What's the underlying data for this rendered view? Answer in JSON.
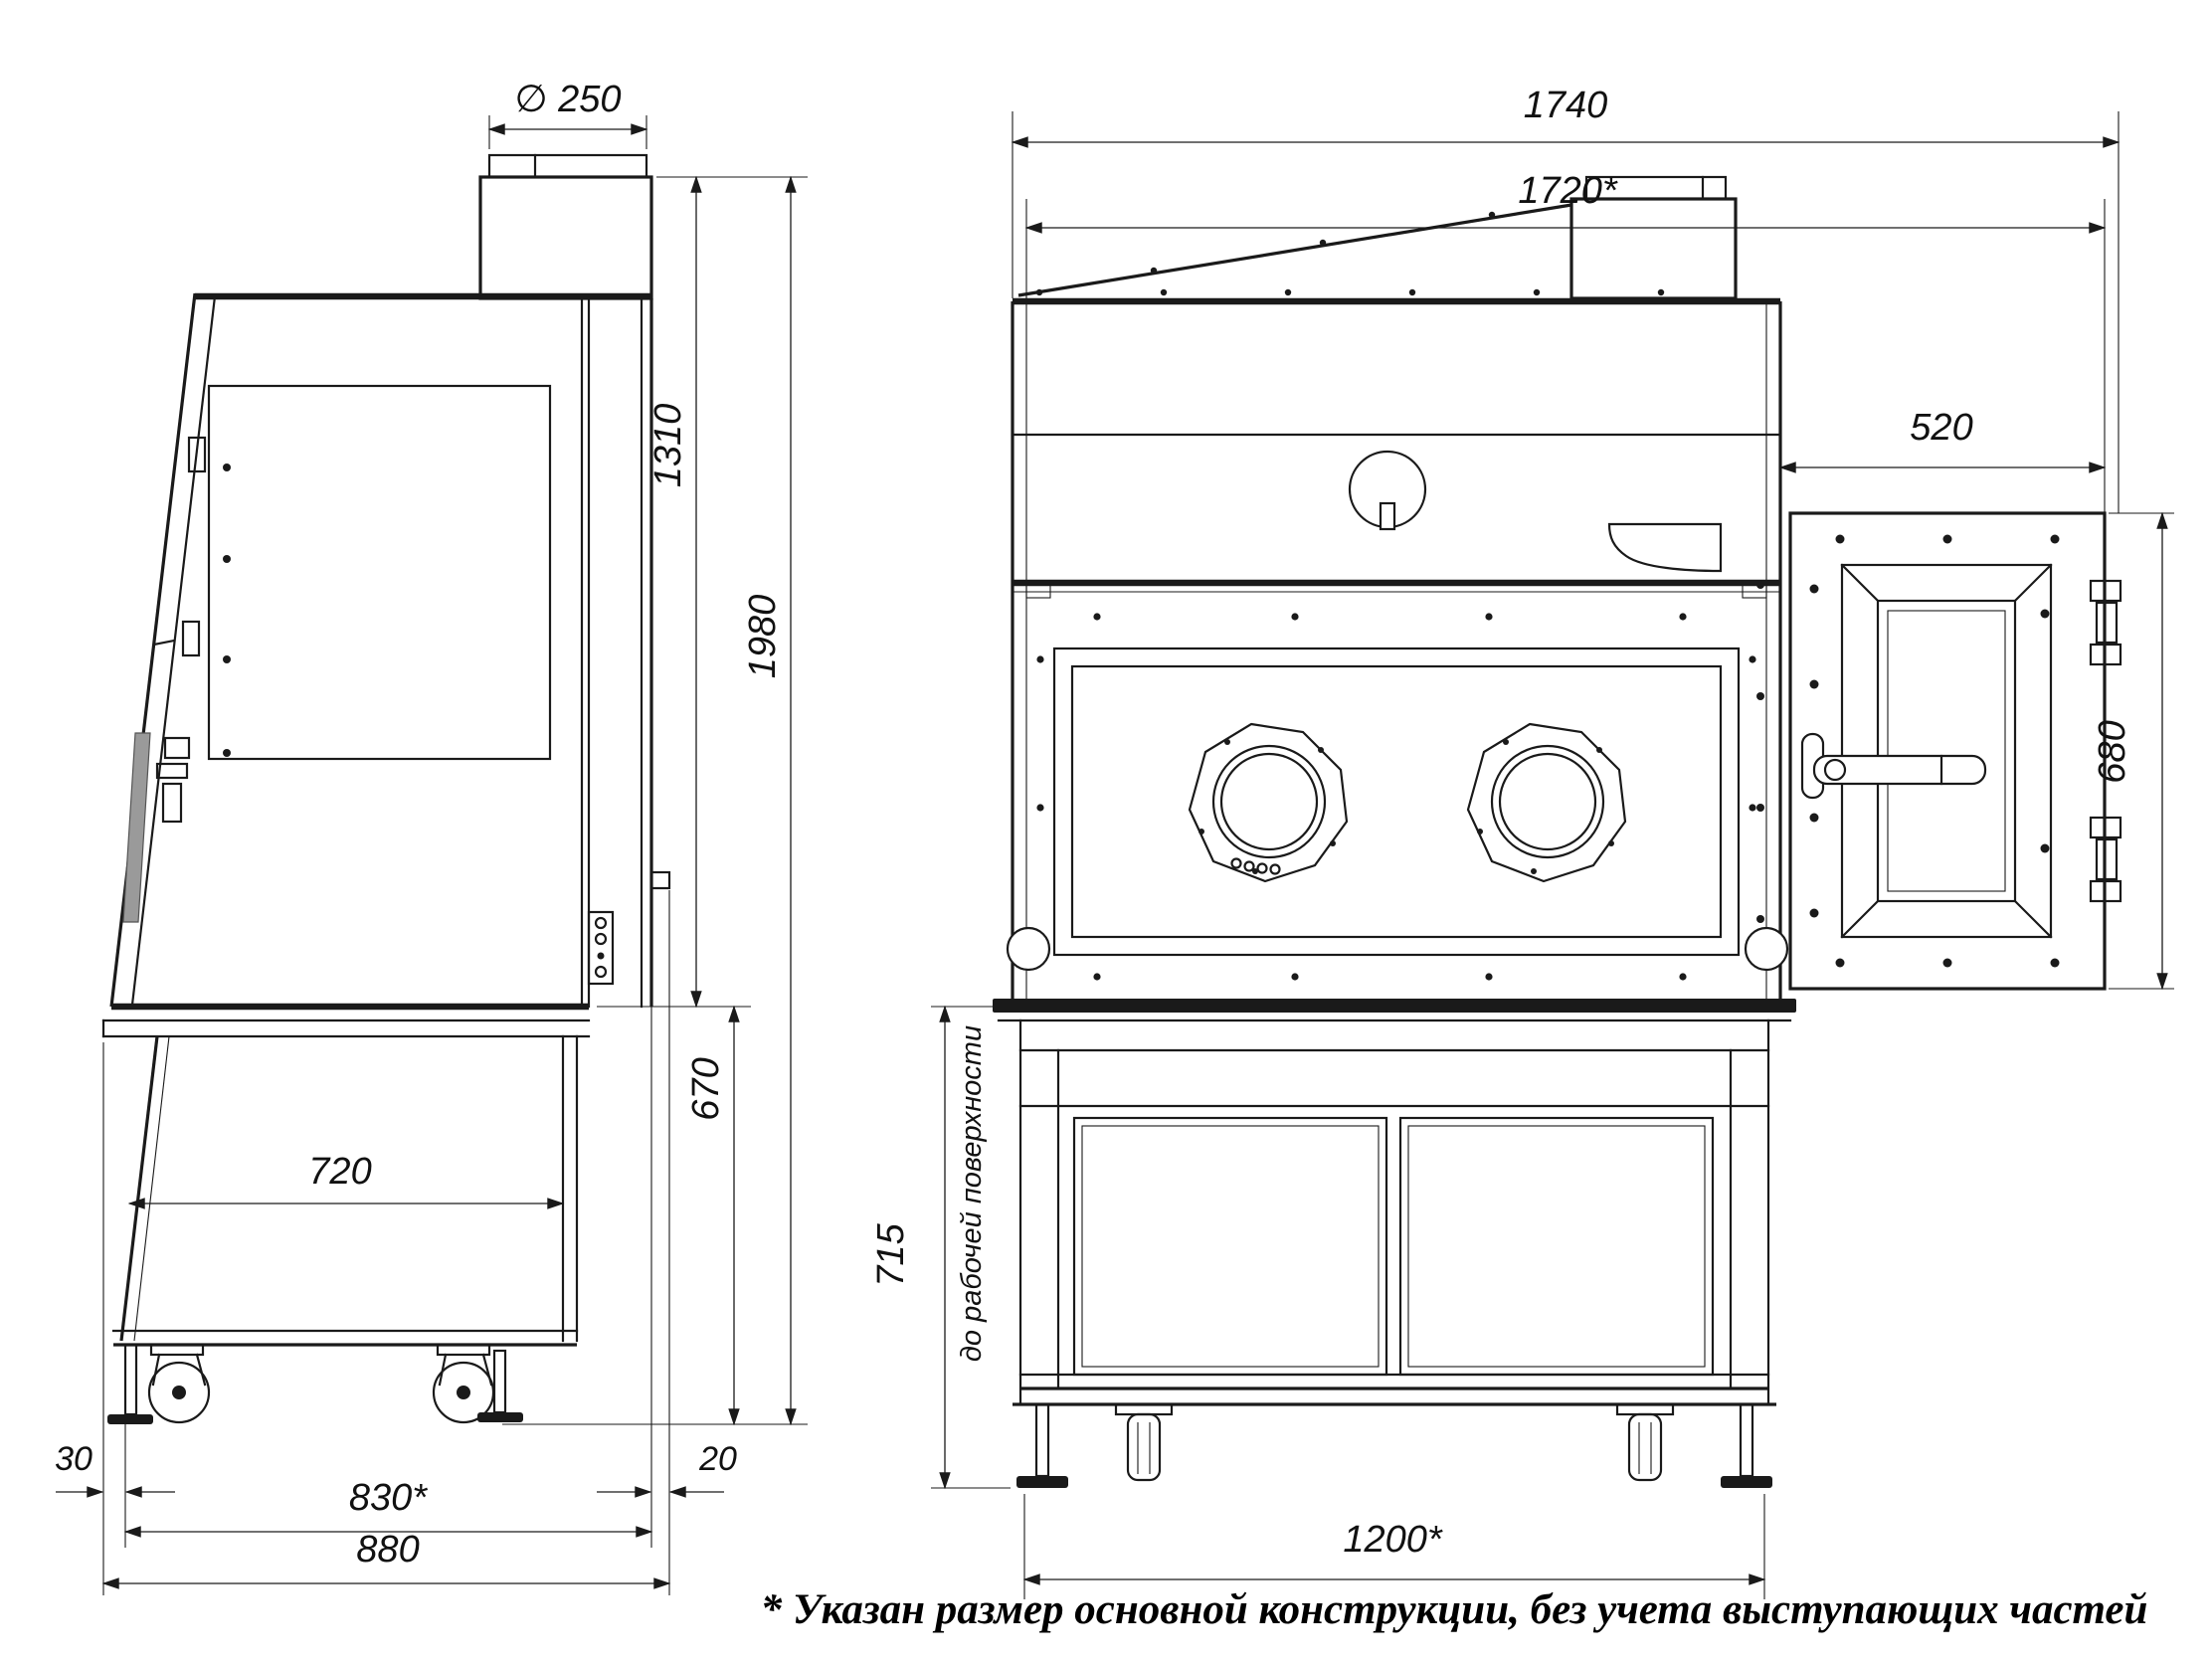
{
  "colors": {
    "line": "#1a1a1a",
    "background": "#ffffff",
    "handle_pad": "#9a9a9a"
  },
  "footnote": "* Указан размер основной конструкции, без учета выступающих частей",
  "side_view": {
    "dims": {
      "duct_diameter": "∅ 250",
      "upper_height": "1310",
      "total_height": "1980",
      "stand_height": "670",
      "stand_depth": "720",
      "front_offset": "30",
      "main_depth": "830*",
      "total_depth": "880",
      "rear_offset": "20"
    }
  },
  "front_view": {
    "dims": {
      "total_width": "1740",
      "main_width": "1720*",
      "door_width": "520",
      "door_height": "680",
      "work_surface_height": "715",
      "work_surface_note": "до рабочей поверхности",
      "stand_width": "1200*"
    }
  }
}
